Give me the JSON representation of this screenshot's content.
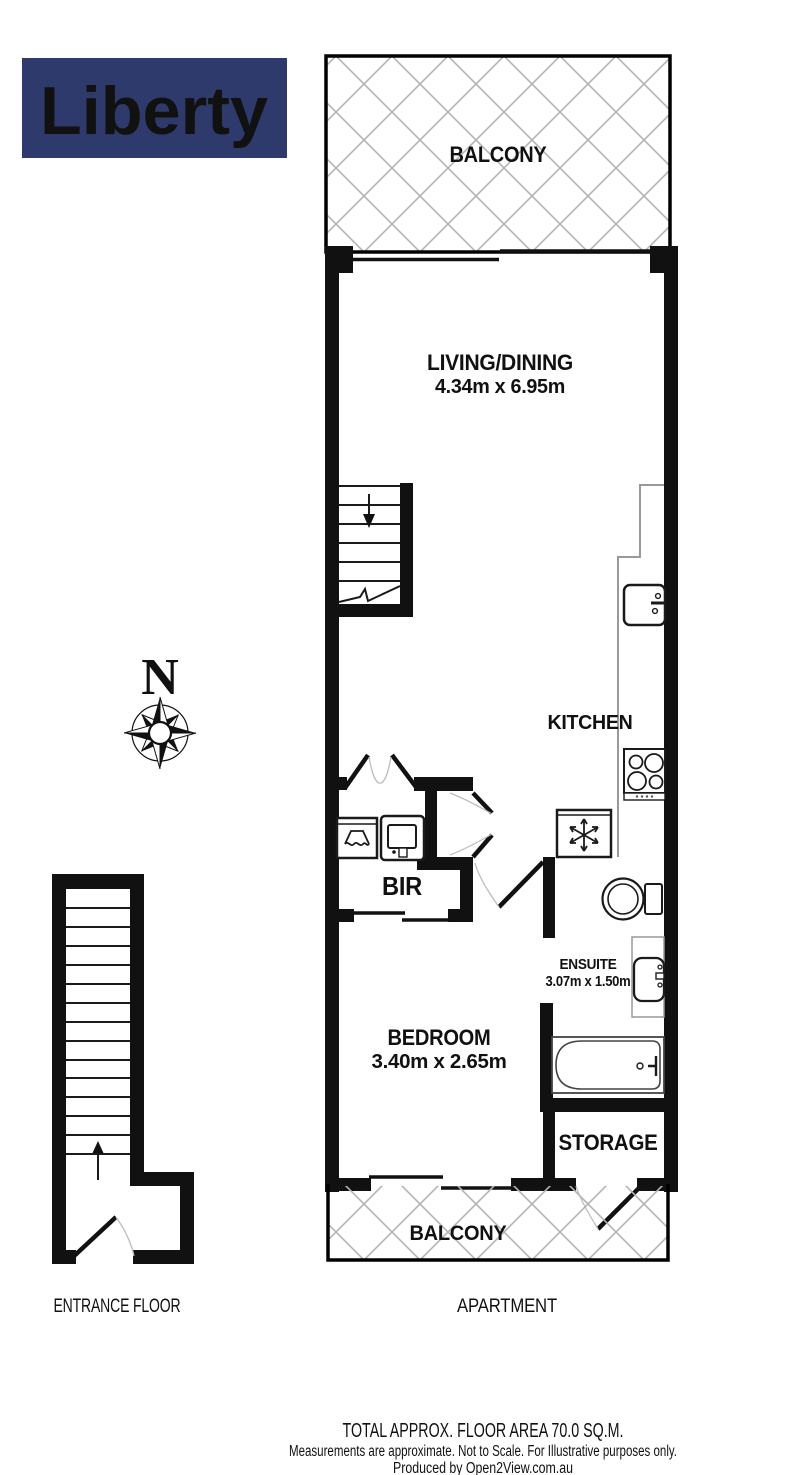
{
  "logo": {
    "text": "Liberty",
    "bg_color": "#2e3a6b",
    "text_color": "#ffffff"
  },
  "compass": {
    "label": "N"
  },
  "rooms": {
    "balcony_top": {
      "name": "BALCONY"
    },
    "living_dining": {
      "name": "LIVING/DINING",
      "dims": "4.34m x 6.95m"
    },
    "kitchen": {
      "name": "KITCHEN"
    },
    "bir": {
      "name": "BIR"
    },
    "bedroom": {
      "name": "BEDROOM",
      "dims": "3.40m x 2.65m"
    },
    "ensuite": {
      "name": "ENSUITE",
      "dims": "3.07m x 1.50m"
    },
    "storage": {
      "name": "STORAGE"
    },
    "balcony_bottom": {
      "name": "BALCONY"
    }
  },
  "floor_labels": {
    "entrance": "ENTRANCE FLOOR",
    "apartment": "APARTMENT"
  },
  "footer": {
    "total_area": "TOTAL APPROX. FLOOR AREA 70.0 SQ.M.",
    "disclaimer": "Measurements are approximate. Not to Scale. For Illustrative purposes only.",
    "producer": "Produced by Open2View.com.au"
  },
  "colors": {
    "wall": "#111111",
    "hatch_line": "#b3b3b3",
    "counter_line": "#999999",
    "logo_navy": "#2e3a6b",
    "text": "#111111"
  }
}
